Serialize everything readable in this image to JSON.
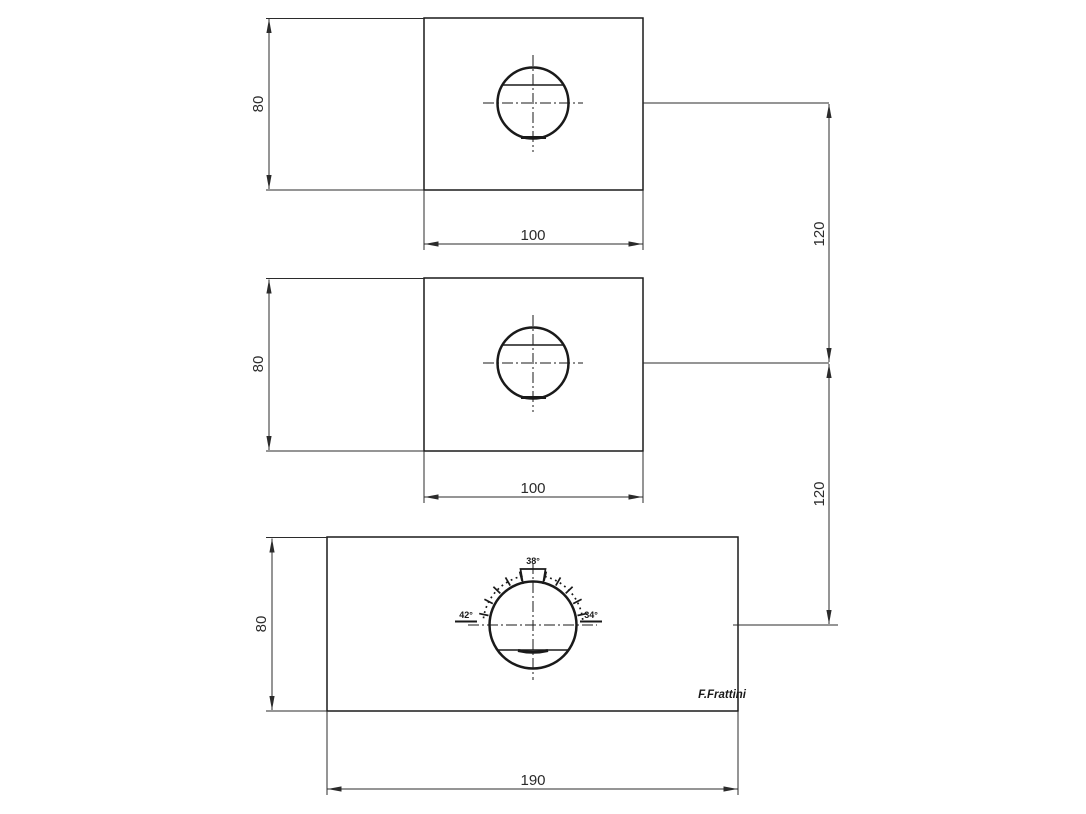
{
  "drawing": {
    "type": "technical-drawing",
    "description": "Three orthographic plate views of a thermostatic mixer body with hole, keyway and temperature dial",
    "background_color": "#ffffff",
    "line_color": "#1a1a1a",
    "dimension_color": "#2b2b2b",
    "views": [
      {
        "name": "top-plate",
        "width_label": "100",
        "height_label": "80"
      },
      {
        "name": "middle-plate",
        "width_label": "100",
        "height_label": "80"
      },
      {
        "name": "bottom-plate",
        "width_label": "190",
        "height_label": "80"
      }
    ],
    "spacing_dims": [
      {
        "label": "120"
      },
      {
        "label": "120"
      }
    ],
    "dial": {
      "left_label": "42°",
      "top_label": "38°",
      "right_label": "34°"
    },
    "logo": "F.Frattini"
  }
}
